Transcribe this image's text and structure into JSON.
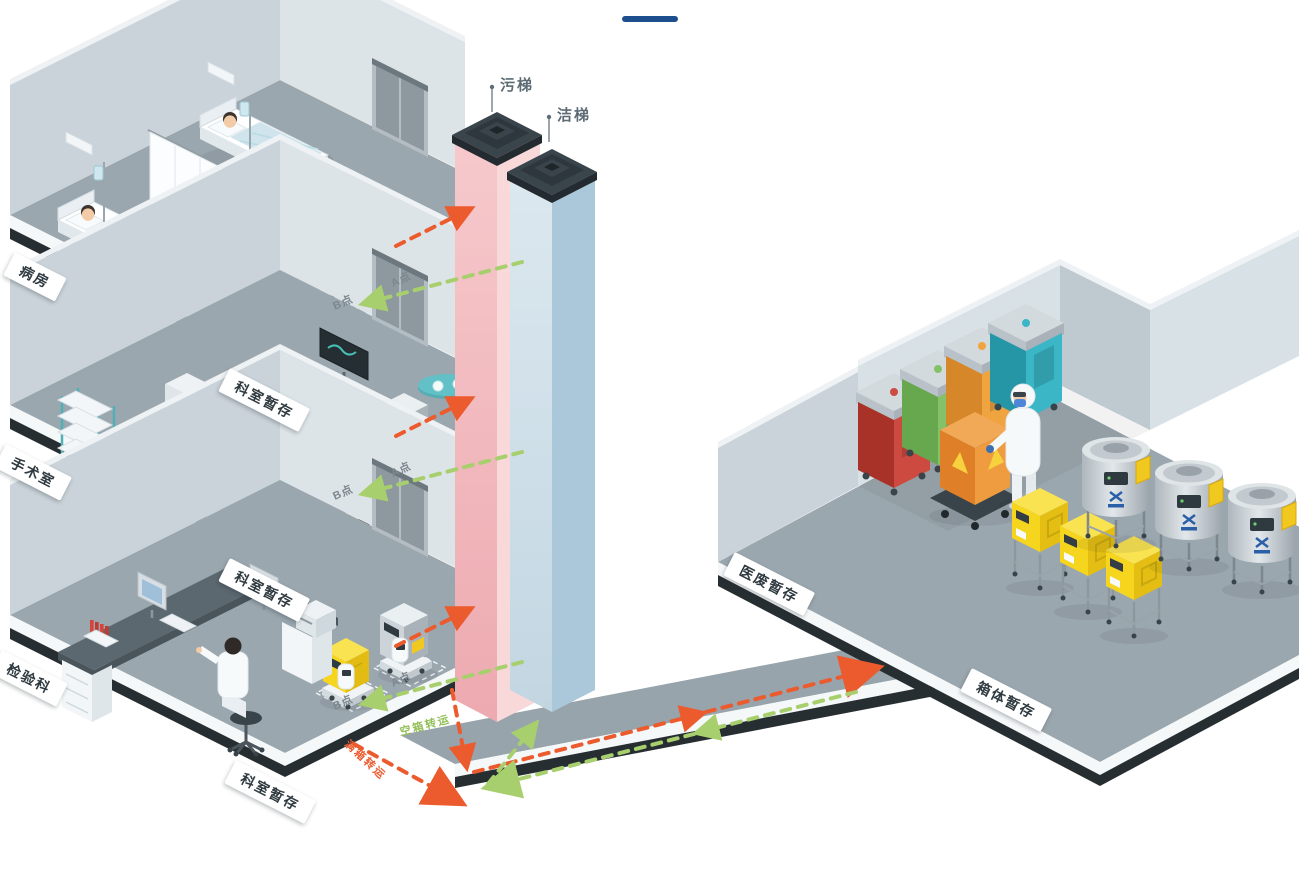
{
  "elevators": {
    "dirty_label": "污梯",
    "clean_label": "洁梯"
  },
  "floors": [
    {
      "name": "病房",
      "storage_label": "科室暂存",
      "point_a": "A点",
      "point_b": "B点"
    },
    {
      "name": "手术室",
      "storage_label": "科室暂存",
      "point_a": "A点",
      "point_b": "B点"
    },
    {
      "name": "检验科",
      "storage_label": "科室暂存",
      "point_a": "A点",
      "point_b": "B点"
    }
  ],
  "right_building": {
    "waste_room_label": "医废暂存",
    "box_storage_label": "箱体暂存"
  },
  "flows": {
    "full_box_label": "满箱转运",
    "empty_box_label": "空箱转运",
    "full_box_color": "#ec5b2e",
    "empty_box_color": "#a8cf6d"
  },
  "palette": {
    "accent_dash": "#1d4f8f",
    "dirty_shaft": "#f0b9be",
    "clean_shaft": "#b9d0e0",
    "waste_box_yellow": "#f6d51f"
  }
}
